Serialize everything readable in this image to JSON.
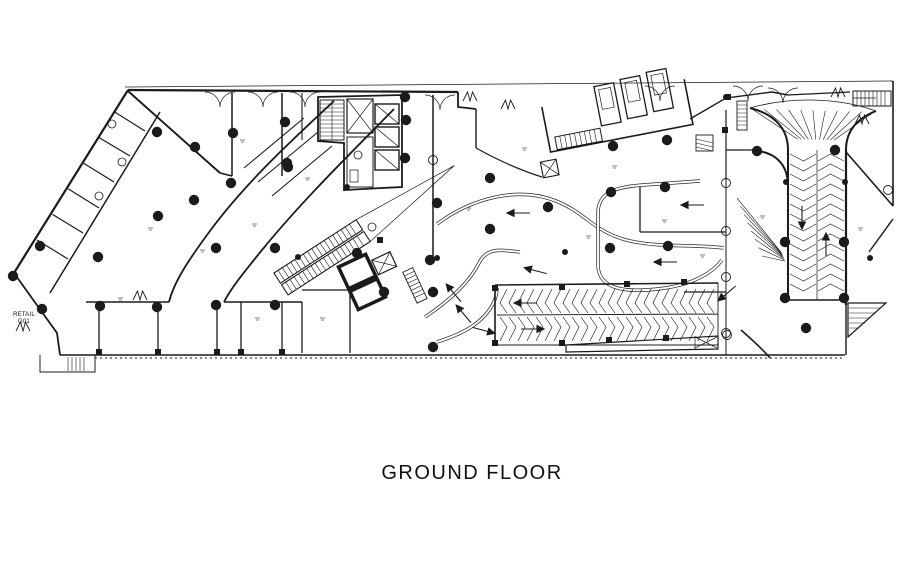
{
  "title": "GROUND FLOOR",
  "labels": {
    "retail_line1": "RETAIL",
    "retail_line2": "G01"
  },
  "colors": {
    "ink": "#1b1b1b",
    "road": "#2a2a2a",
    "background": "#ffffff",
    "tick": "#555555"
  },
  "columns": [
    [
      157,
      132
    ],
    [
      195,
      147
    ],
    [
      233,
      133
    ],
    [
      285,
      122
    ],
    [
      288,
      167
    ],
    [
      231,
      183
    ],
    [
      194,
      200
    ],
    [
      158,
      216
    ],
    [
      98,
      257
    ],
    [
      40,
      246
    ],
    [
      13,
      276
    ],
    [
      42,
      309
    ],
    [
      100,
      306
    ],
    [
      157,
      307
    ],
    [
      216,
      305
    ],
    [
      216,
      248
    ],
    [
      275,
      248
    ],
    [
      275,
      305
    ],
    [
      287,
      163
    ],
    [
      384,
      292
    ],
    [
      357,
      253
    ],
    [
      430,
      260
    ],
    [
      433,
      292
    ],
    [
      433,
      347
    ],
    [
      405,
      97
    ],
    [
      406,
      120
    ],
    [
      405,
      158
    ],
    [
      437,
      203
    ],
    [
      490,
      178
    ],
    [
      490,
      229
    ],
    [
      548,
      207
    ],
    [
      611,
      192
    ],
    [
      665,
      187
    ],
    [
      613,
      146
    ],
    [
      667,
      140
    ],
    [
      610,
      248
    ],
    [
      668,
      246
    ],
    [
      757,
      151
    ],
    [
      835,
      150
    ],
    [
      785,
      242
    ],
    [
      844,
      242
    ],
    [
      785,
      298
    ],
    [
      844,
      298
    ],
    [
      806,
      328
    ]
  ],
  "small_dots": [
    [
      870,
      258
    ],
    [
      786,
      182
    ],
    [
      845,
      182
    ],
    [
      565,
      252
    ],
    [
      437,
      258
    ],
    [
      726,
      97
    ],
    [
      347,
      187
    ],
    [
      298,
      257
    ]
  ],
  "posts": [
    [
      99,
      352
    ],
    [
      158,
      352
    ],
    [
      217,
      352
    ],
    [
      241,
      352
    ],
    [
      282,
      352
    ],
    [
      495,
      288
    ],
    [
      495,
      343
    ],
    [
      562,
      287
    ],
    [
      562,
      343
    ],
    [
      609,
      340
    ],
    [
      666,
      338
    ],
    [
      627,
      284
    ],
    [
      684,
      282
    ],
    [
      725,
      130
    ],
    [
      728,
      97
    ],
    [
      380,
      240
    ]
  ],
  "bubbles": [
    [
      726,
      183
    ],
    [
      726,
      231
    ],
    [
      726,
      277
    ],
    [
      726,
      333
    ],
    [
      433,
      160
    ],
    [
      888,
      190
    ],
    [
      727,
      335
    ]
  ],
  "fixtures": [
    [
      112,
      124
    ],
    [
      122,
      162
    ],
    [
      99,
      196
    ],
    [
      372,
      227
    ],
    [
      358,
      155
    ]
  ],
  "arrows": [
    [
      516,
      213,
      180
    ],
    [
      533,
      270,
      195
    ],
    [
      663,
      262,
      180
    ],
    [
      690,
      205,
      180
    ],
    [
      452,
      291,
      230
    ],
    [
      462,
      312,
      230
    ],
    [
      486,
      331,
      15
    ],
    [
      725,
      295,
      140
    ],
    [
      523,
      303,
      180
    ],
    [
      535,
      329,
      0
    ],
    [
      802,
      220,
      90
    ],
    [
      826,
      242,
      270
    ]
  ],
  "ramps": [
    {
      "name": "ramp-south",
      "orient": "h",
      "x1": 500,
      "x2": 712,
      "y1": 289,
      "y2": 341,
      "mid": 315,
      "step": 9
    },
    {
      "name": "ramp-east",
      "orient": "v",
      "y1": 154,
      "y2": 292,
      "x1": 790,
      "x2": 844,
      "mid": 817,
      "step": 10
    }
  ],
  "fans": [
    {
      "focal": [
        817,
        152
      ],
      "from": [
        752,
        109
      ],
      "to": [
        874,
        112
      ],
      "n": 11,
      "inner": 0.3
    },
    {
      "focal": [
        789,
        262
      ],
      "from": [
        737,
        198
      ],
      "to": [
        762,
        256
      ],
      "n": 8,
      "inner": 0.15
    }
  ],
  "doors": {
    "double": [
      [
        205,
        92
      ],
      [
        248,
        92
      ],
      [
        290,
        92
      ],
      [
        425,
        95
      ],
      [
        645,
        86
      ],
      [
        733,
        86
      ],
      [
        768,
        88
      ]
    ],
    "butterfly": [
      [
        23,
        331
      ],
      [
        140,
        300
      ],
      [
        470,
        101
      ],
      [
        508,
        109
      ],
      [
        862,
        124
      ],
      [
        838,
        97
      ]
    ]
  },
  "ticks": [
    [
      148,
      228
    ],
    [
      252,
      224
    ],
    [
      305,
      178
    ],
    [
      466,
      208
    ],
    [
      522,
      148
    ],
    [
      612,
      166
    ],
    [
      662,
      220
    ],
    [
      760,
      216
    ],
    [
      858,
      228
    ],
    [
      118,
      298
    ],
    [
      255,
      318
    ],
    [
      320,
      318
    ],
    [
      700,
      255
    ],
    [
      586,
      236
    ],
    [
      240,
      140
    ],
    [
      200,
      250
    ]
  ]
}
